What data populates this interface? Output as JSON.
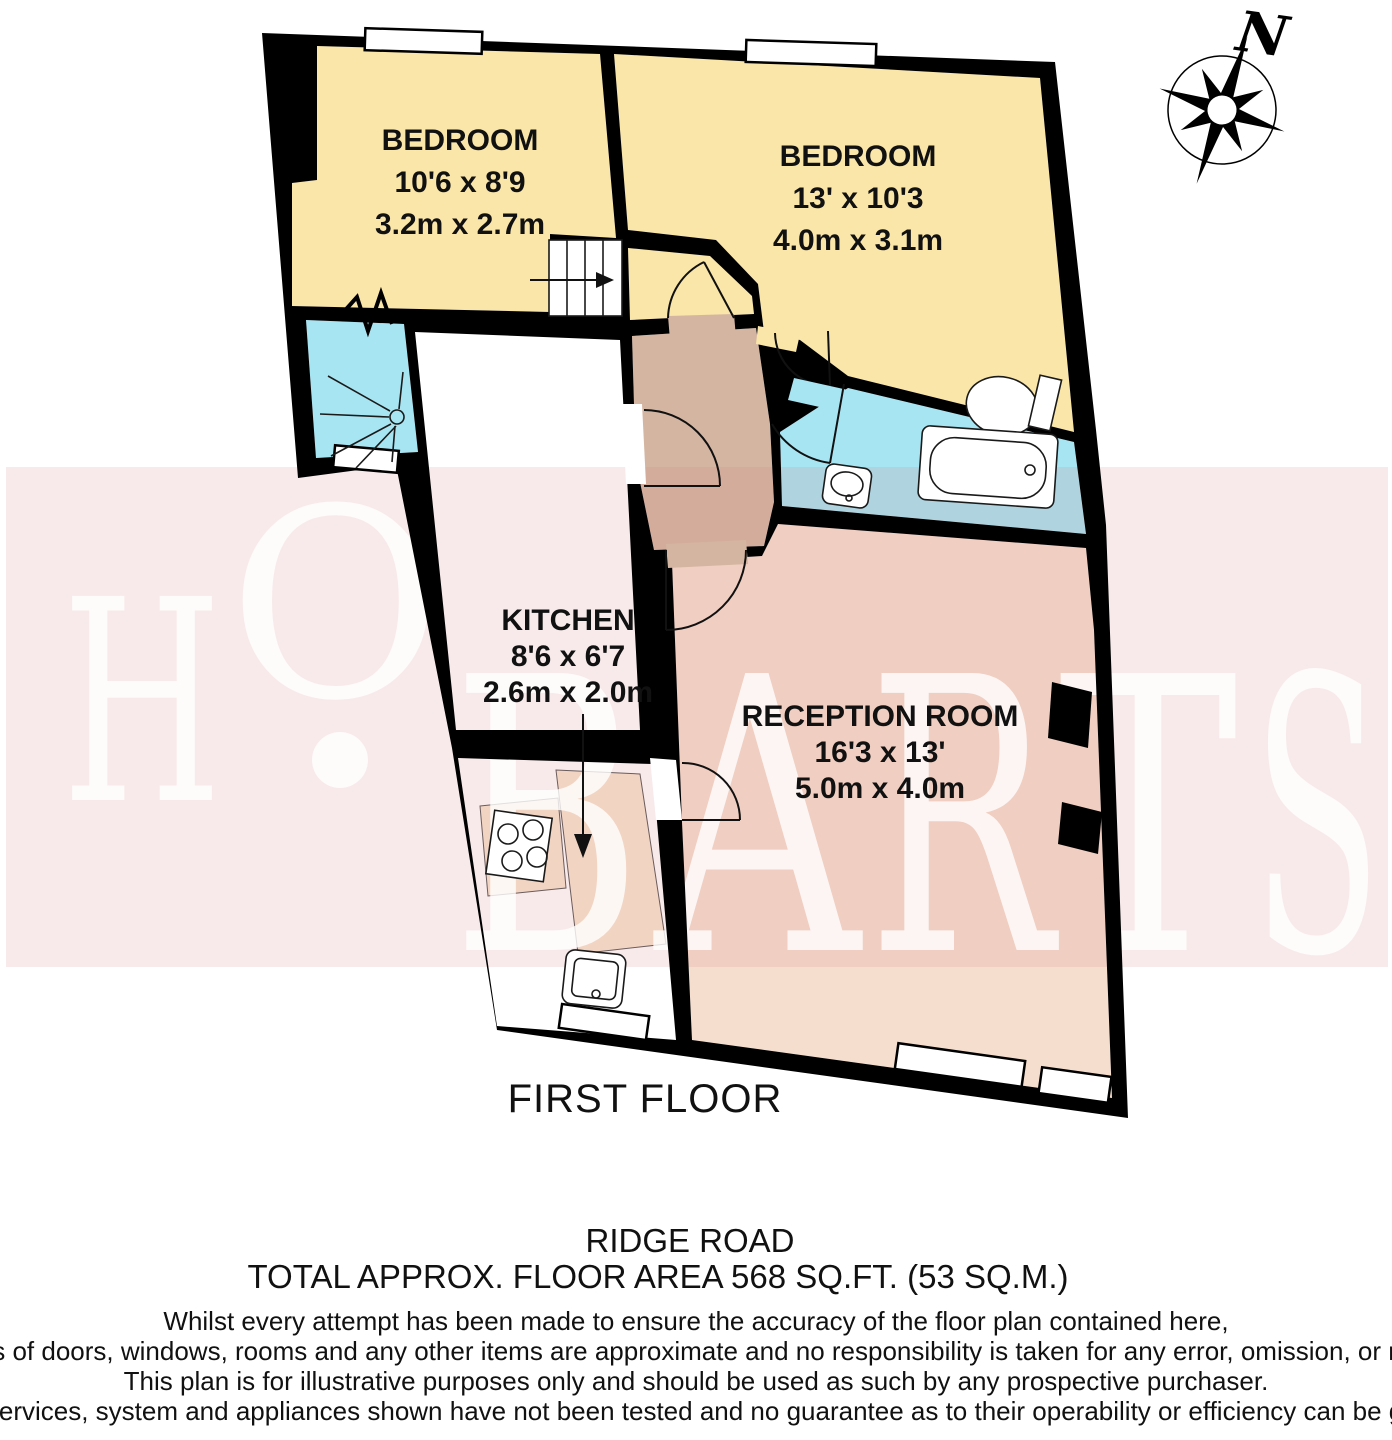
{
  "plan": {
    "floor_title": "FIRST FLOOR",
    "address": "RIDGE ROAD",
    "total_area": "TOTAL APPROX. FLOOR AREA 568 SQ.FT. (53 SQ.M.)"
  },
  "rooms": {
    "bedroom1": {
      "name": "BEDROOM",
      "imperial": "10'6 x 8'9",
      "metric": "3.2m x 2.7m"
    },
    "bedroom2": {
      "name": "BEDROOM",
      "imperial": "13' x 10'3",
      "metric": "4.0m x 3.1m"
    },
    "kitchen": {
      "name": "KITCHEN",
      "imperial": "8'6 x 6'7",
      "metric": "2.6m x 2.0m"
    },
    "reception": {
      "name": "RECEPTION ROOM",
      "imperial": "16'3 x 13'",
      "metric": "5.0m x 4.0m"
    }
  },
  "compass": {
    "north_label": "N"
  },
  "watermark": {
    "l0": "H",
    "l1": "O",
    "l2": "B",
    "l3": "A",
    "l4": "R",
    "l5": "T",
    "l6": "S"
  },
  "disclaimer": [
    "Whilst every attempt has been made to ensure the accuracy of the floor plan contained here,",
    "measurements of doors, windows, rooms and any other items are approximate and no responsibility is taken for any error, omission, or mis-statement.",
    "This plan is for illustrative purposes only and should be used as such by any prospective purchaser.",
    "The services, system and appliances shown have not been tested and no guarantee as to their operability or efficiency can be given."
  ],
  "colors": {
    "bedroom": "#FAE6A8",
    "bathroom_cyan": "#A8E5F3",
    "hall_tan": "#D4B5A1",
    "reception_peach": "#F6DECE",
    "counter": "#F8E5D0",
    "walls": "#000000",
    "watermark_band": "#E08080",
    "watermark_letters": "#FFFFFF"
  }
}
